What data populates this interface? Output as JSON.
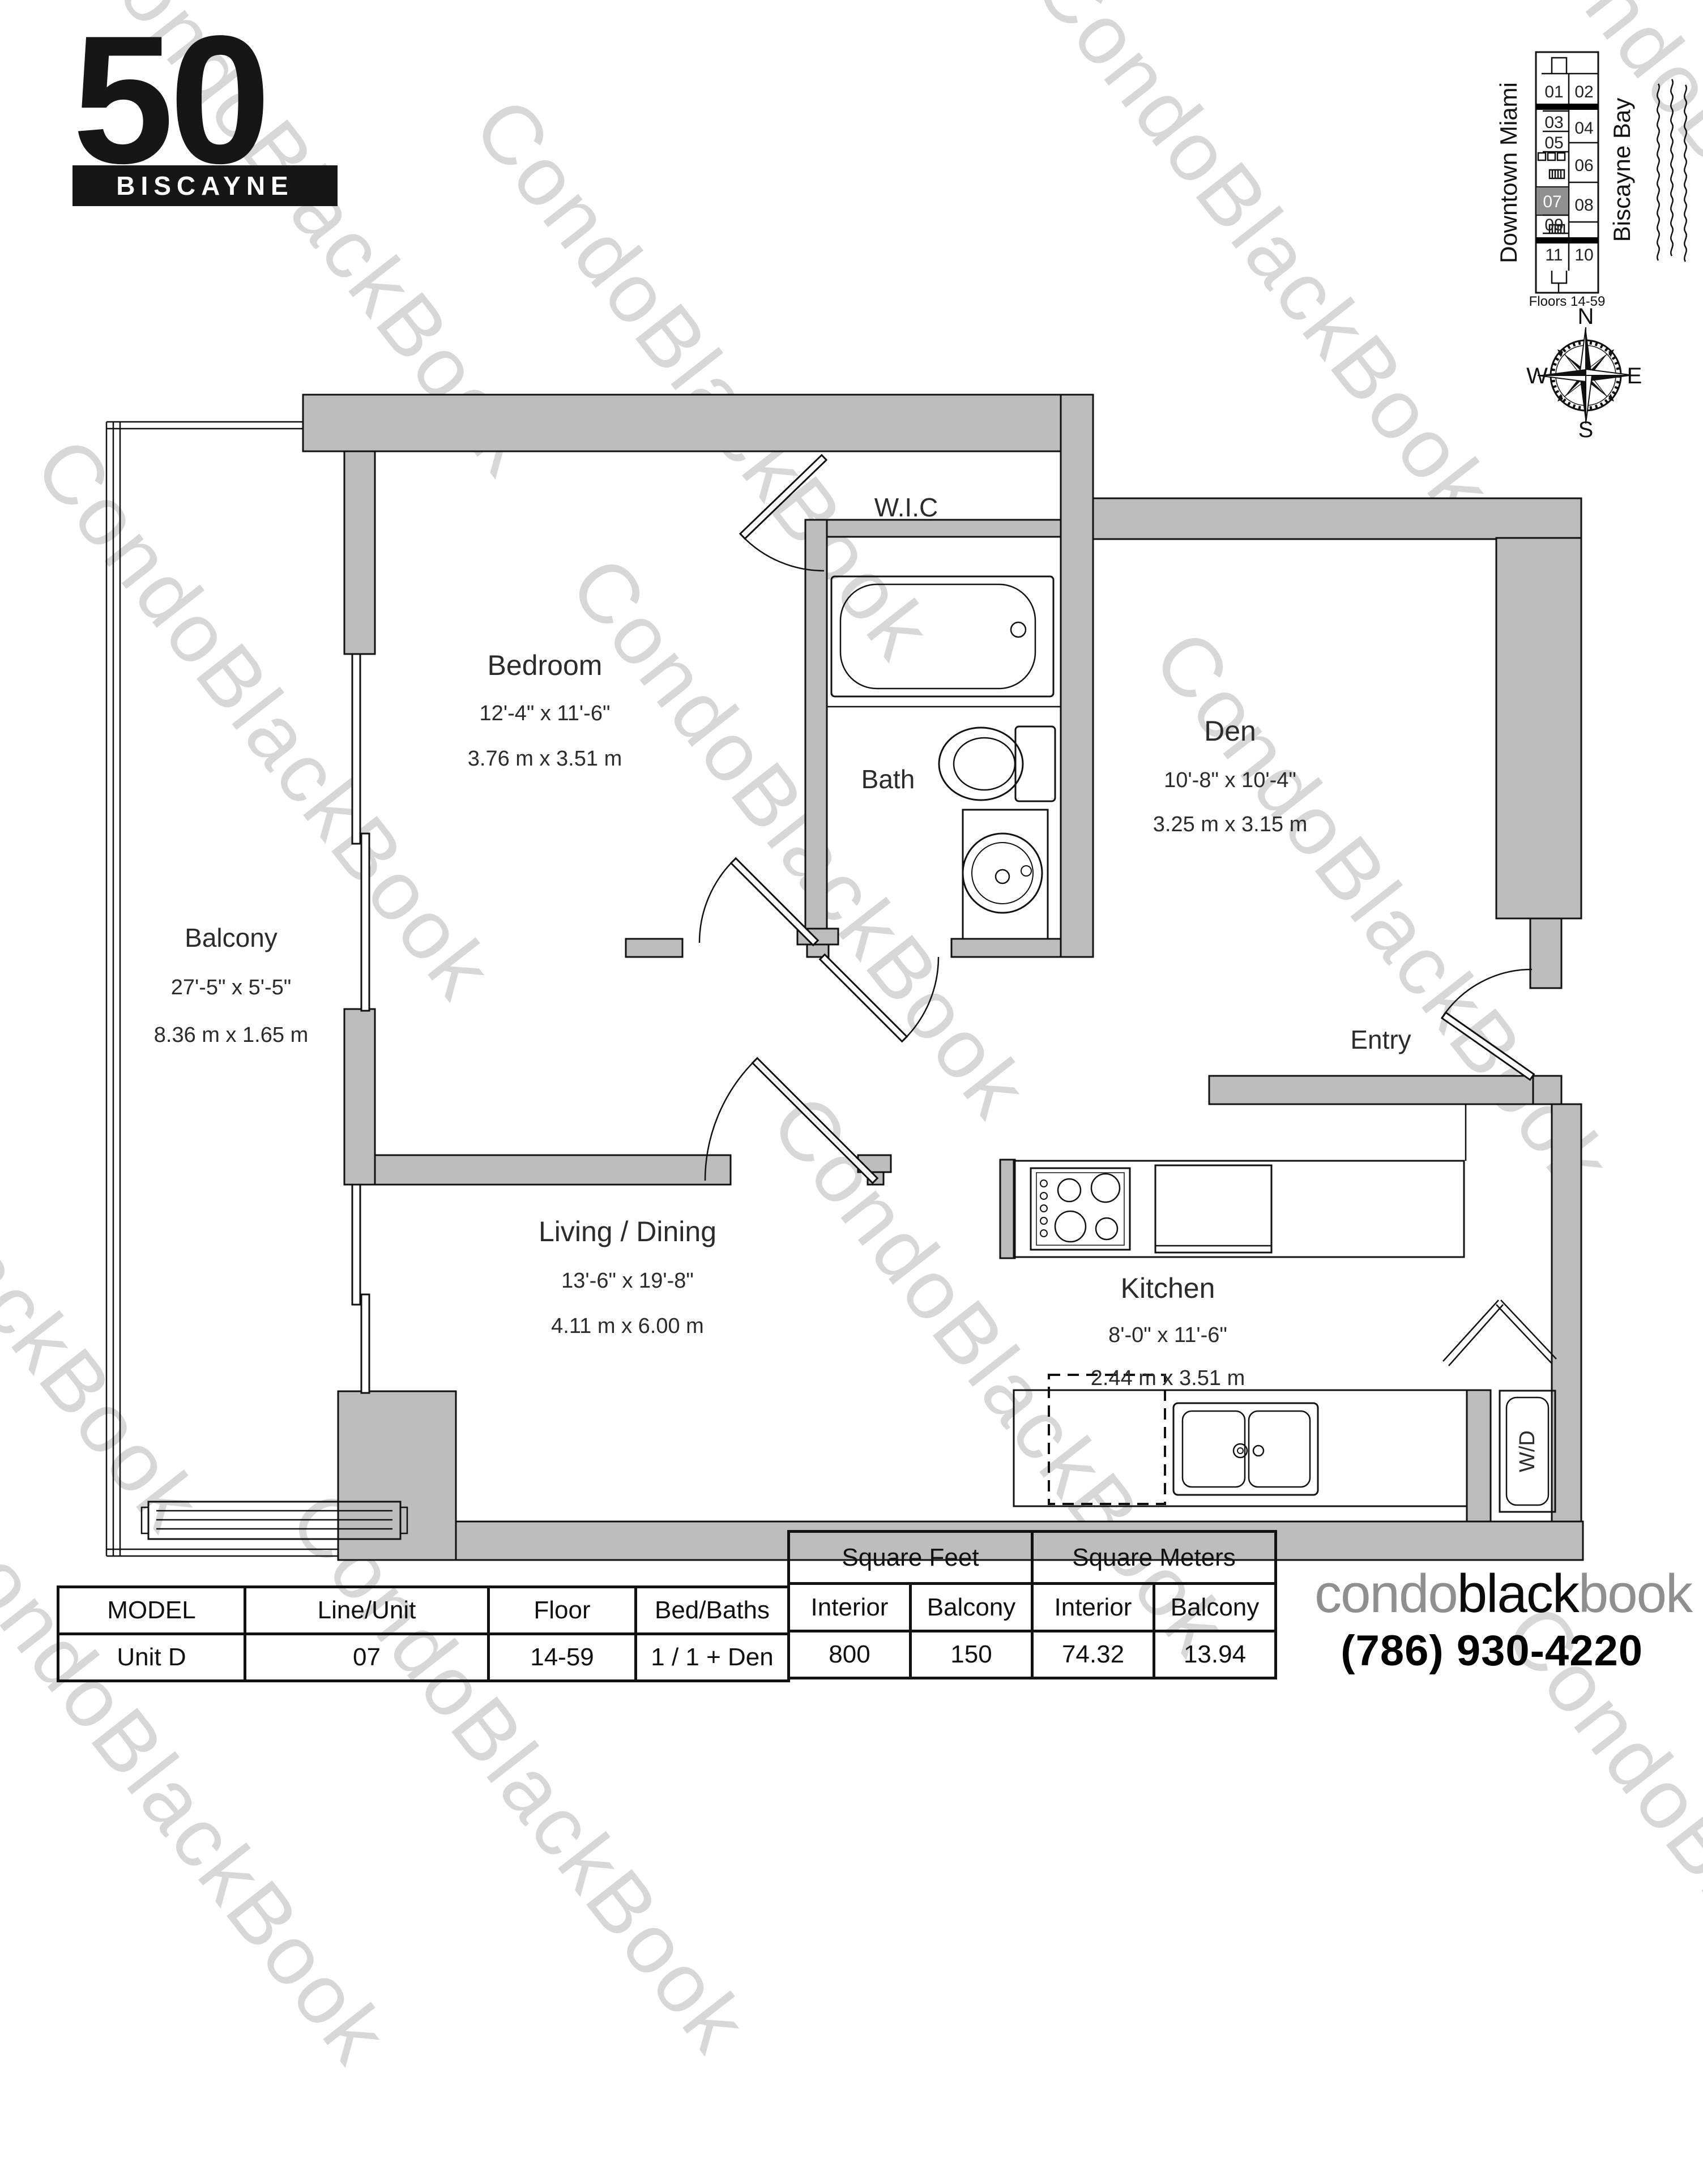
{
  "branding": {
    "logo_number": "50",
    "logo_name": "BISCAYNE",
    "watermark_text": "CondoBlackBook",
    "footer_logo_condo": "condo",
    "footer_logo_black": "black",
    "footer_logo_book": "book",
    "phone": "(786) 930-4220"
  },
  "key_plan": {
    "left_label": "Downtown Miami",
    "right_label": "Biscayne Bay",
    "caption": "Floors 14-59",
    "highlighted_unit": "07",
    "units": [
      {
        "label": "01"
      },
      {
        "label": "02"
      },
      {
        "label": "03"
      },
      {
        "label": "04"
      },
      {
        "label": "05"
      },
      {
        "label": "06"
      },
      {
        "label": "07"
      },
      {
        "label": "08"
      },
      {
        "label": "09"
      },
      {
        "label": "11"
      },
      {
        "label": "10"
      }
    ]
  },
  "compass": {
    "n": "N",
    "e": "E",
    "s": "S",
    "w": "W"
  },
  "rooms": {
    "wic": {
      "name": "W.I.C"
    },
    "bedroom": {
      "name": "Bedroom",
      "dim_ft": "12'-4\" x 11'-6\"",
      "dim_m": "3.76 m x 3.51 m"
    },
    "bath": {
      "name": "Bath"
    },
    "den": {
      "name": "Den",
      "dim_ft": "10'-8\" x 10'-4\"",
      "dim_m": "3.25 m x 3.15 m"
    },
    "balcony": {
      "name": "Balcony",
      "dim_ft": "27'-5\" x 5'-5\"",
      "dim_m": "8.36 m x 1.65 m"
    },
    "entry": {
      "name": "Entry"
    },
    "living": {
      "name": "Living / Dining",
      "dim_ft": "13'-6\" x 19'-8\"",
      "dim_m": "4.11 m x 6.00 m"
    },
    "kitchen": {
      "name": "Kitchen",
      "dim_ft": "8'-0\" x 11'-6\"",
      "dim_m": "2.44 m x 3.51 m"
    },
    "laundry": {
      "name": "W/D"
    }
  },
  "table": {
    "model_header": "MODEL",
    "line_header": "Line/Unit",
    "floor_header": "Floor",
    "bedbaths_header": "Bed/Baths",
    "sqft_header": "Square Feet",
    "sqm_header": "Square Meters",
    "interior_header": "Interior",
    "balcony_header": "Balcony",
    "unit": {
      "model": "Unit D",
      "line": "07",
      "floor": "14-59",
      "bedbaths": "1 / 1 + Den",
      "sqft_interior": "800",
      "sqft_balcony": "150",
      "sqm_interior": "74.32",
      "sqm_balcony": "13.94"
    }
  },
  "colors": {
    "wall": "#bdbdbd",
    "watermark": "#d7d7d7",
    "ink": "#111111",
    "gray_logo": "#8f8f8f"
  }
}
